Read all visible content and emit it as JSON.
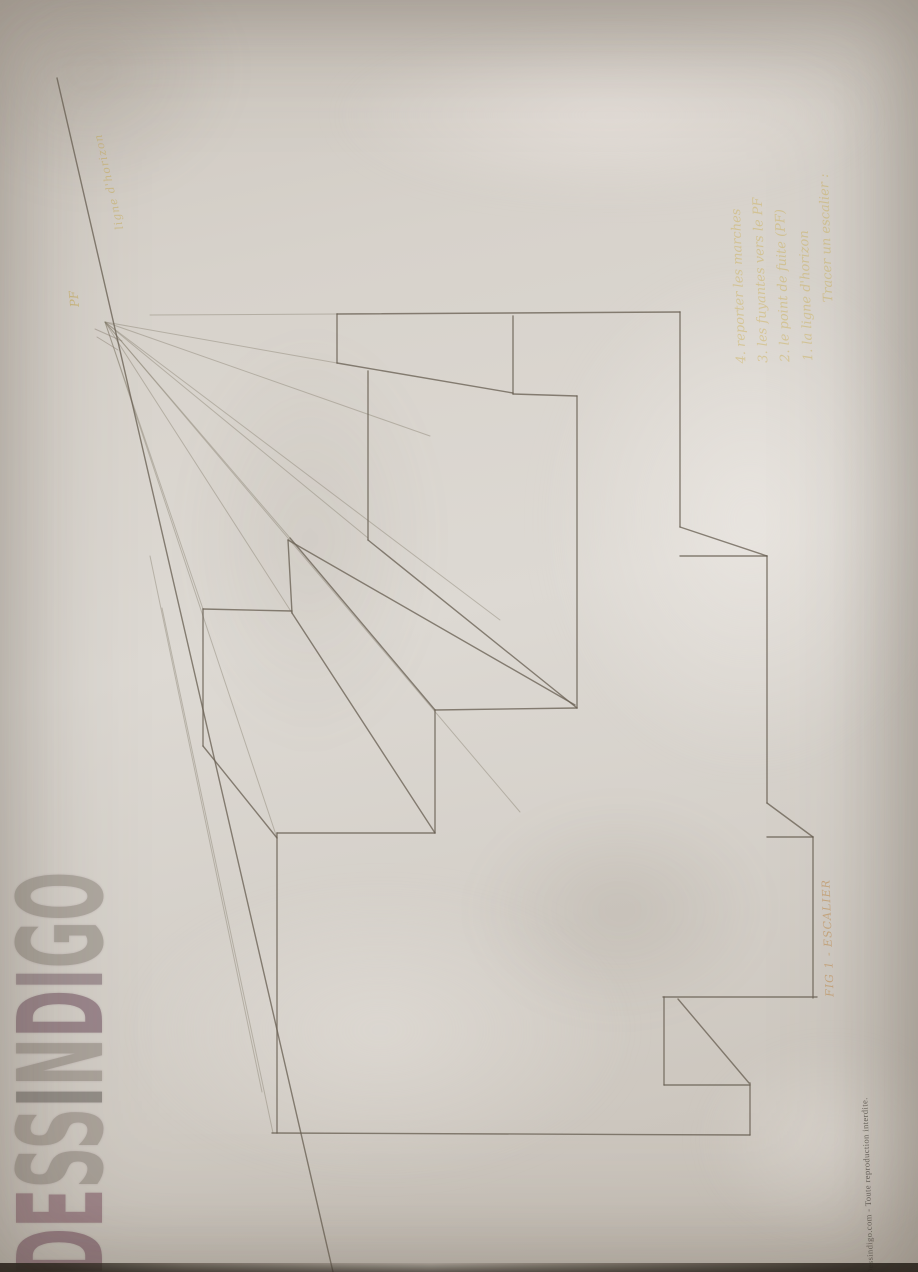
{
  "photo": {
    "description": "photo of a pencil one-point-perspective staircase drawing",
    "watermark": {
      "text": "DESSINDIGO",
      "letters": [
        {
          "ch": "D",
          "color": "#6b3f54"
        },
        {
          "ch": "E",
          "color": "#7a4f5e"
        },
        {
          "ch": "S",
          "color": "#8a8178"
        },
        {
          "ch": "S",
          "color": "#8d847a"
        },
        {
          "ch": "I",
          "color": "#5f5a55"
        },
        {
          "ch": "N",
          "color": "#8a8178"
        },
        {
          "ch": "D",
          "color": "#6b4a5a"
        },
        {
          "ch": "I",
          "color": "#77606a"
        },
        {
          "ch": "G",
          "color": "#8b837a"
        },
        {
          "ch": "O",
          "color": "#8d857c"
        }
      ]
    },
    "copyright": "Dessindigo.com - Toute reproduction interdite.",
    "labels": {
      "horizon": "ligne d'horizon",
      "vanishing_point": "PF",
      "figure": "FIG 1 - ESCALIER"
    },
    "annotation": {
      "color": "#c9a83c",
      "lines": [
        "Tracer un escalier :",
        "1. la ligne d'horizon",
        "2. le point de fuite (PF)",
        "3. les fuyantes vers le PF",
        "4. reporter les marches"
      ]
    },
    "drawing": {
      "pencil_color": "#6a6254",
      "construction_color": "#847b6c",
      "vanishing_point": {
        "x": 105,
        "y": 322
      },
      "segments": [
        [
          57,
          78,
          333,
          1272
        ],
        [
          337,
          314,
          680,
          312
        ],
        [
          337,
          314,
          337,
          363
        ],
        [
          337,
          363,
          513,
          393
        ],
        [
          368,
          371,
          368,
          540
        ],
        [
          513,
          316,
          513,
          394
        ],
        [
          513,
          394,
          577,
          396
        ],
        [
          577,
          396,
          577,
          708
        ],
        [
          680,
          312,
          680,
          527
        ],
        [
          680,
          527,
          767,
          556
        ],
        [
          680,
          556,
          767,
          556
        ],
        [
          767,
          556,
          767,
          803
        ],
        [
          767,
          803,
          813,
          837
        ],
        [
          767,
          837,
          813,
          837
        ],
        [
          813,
          837,
          813,
          998
        ],
        [
          663,
          997,
          817,
          997
        ],
        [
          664,
          997,
          664,
          1085
        ],
        [
          678,
          999,
          749,
          1083
        ],
        [
          664,
          1085,
          750,
          1085
        ],
        [
          750,
          1083,
          750,
          1135
        ],
        [
          272,
          1133,
          750,
          1135
        ],
        [
          277,
          833,
          277,
          1133
        ],
        [
          277,
          833,
          435,
          833
        ],
        [
          292,
          613,
          435,
          833
        ],
        [
          435,
          710,
          435,
          833
        ],
        [
          435,
          710,
          577,
          708
        ],
        [
          290,
          538,
          435,
          710
        ],
        [
          288,
          540,
          292,
          613
        ],
        [
          203,
          609,
          292,
          611
        ],
        [
          203,
          609,
          203,
          746
        ],
        [
          203,
          746,
          277,
          838
        ],
        [
          288,
          540,
          575,
          705
        ],
        [
          368,
          540,
          577,
          708
        ]
      ],
      "construction": [
        [
          105,
          322,
          337,
          363
        ],
        [
          105,
          322,
          292,
          613
        ],
        [
          105,
          322,
          290,
          538
        ],
        [
          105,
          322,
          203,
          609
        ],
        [
          105,
          322,
          277,
          838
        ],
        [
          105,
          322,
          500,
          620
        ],
        [
          105,
          322,
          430,
          436
        ],
        [
          105,
          322,
          520,
          812
        ],
        [
          105,
          322,
          368,
          538
        ],
        [
          150,
          315,
          337,
          314
        ],
        [
          162,
          608,
          273,
          1133
        ],
        [
          150,
          556,
          262,
          1092
        ]
      ],
      "ticks": [
        [
          95,
          329,
          122,
          341
        ],
        [
          97,
          337,
          118,
          350
        ]
      ]
    }
  }
}
